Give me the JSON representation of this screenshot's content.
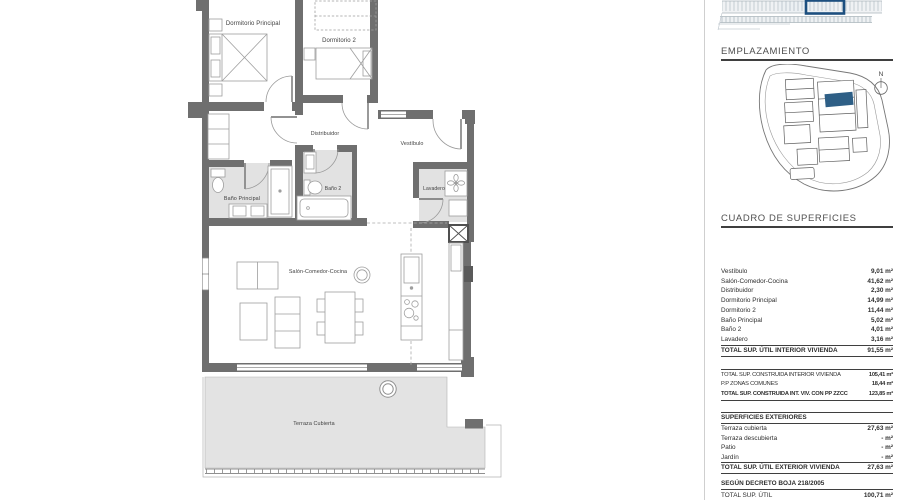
{
  "plan": {
    "labels": {
      "dorm_principal": "Dormitorio Principal",
      "dorm2": "Dormitorio 2",
      "distribuidor": "Distribuidor",
      "vestibulo": "Vestíbulo",
      "bano_principal": "Baño Principal",
      "bano2": "Baño 2",
      "lavadero": "Lavadero",
      "salon": "Salón-Comedor-Cocina",
      "terraza": "Terraza Cubierta"
    }
  },
  "sidebar": {
    "emplazamiento": {
      "title": "EMPLAZAMIENTO",
      "compass": "N"
    },
    "cuadro": {
      "title": "CUADRO DE SUPERFICIES"
    },
    "interior": {
      "rows": [
        {
          "label": "Vestíbulo",
          "value": "9,01 m²"
        },
        {
          "label": "Salón-Comedor-Cocina",
          "value": "41,62 m²"
        },
        {
          "label": "Distribuidor",
          "value": "2,30 m²"
        },
        {
          "label": "Dormitorio Principal",
          "value": "14,99 m²"
        },
        {
          "label": "Dormitorio 2",
          "value": "11,44 m²"
        },
        {
          "label": "Baño Principal",
          "value": "5,02 m²"
        },
        {
          "label": "Baño 2",
          "value": "4,01 m²"
        },
        {
          "label": "Lavadero",
          "value": "3,16 m²"
        }
      ],
      "total": {
        "label": "TOTAL SUP. ÚTIL INTERIOR VIVIENDA",
        "value": "91,55 m²"
      }
    },
    "construida": {
      "rows": [
        {
          "label": "TOTAL SUP. CONSTRUIDA INTERIOR VIVIENDA",
          "value": "105,41 m²"
        },
        {
          "label": "P.P ZONAS COMUNES",
          "value": "18,44 m²"
        },
        {
          "label": "TOTAL SUP. CONSTRUIDA INT. VIV. CON PP ZZCC",
          "value": "123,85 m²"
        }
      ]
    },
    "exteriores": {
      "header": "SUPERFICIES EXTERIORES",
      "rows": [
        {
          "label": "Terraza cubierta",
          "value": "27,63 m²"
        },
        {
          "label": "Terraza descubierta",
          "value": "- m²"
        },
        {
          "label": "Patio",
          "value": "- m²"
        },
        {
          "label": "Jardín",
          "value": "- m²"
        }
      ],
      "total": {
        "label": "TOTAL SUP. ÚTIL EXTERIOR VIVIENDA",
        "value": "27,63 m²"
      }
    },
    "decreto": {
      "header": "SEGÚN DECRETO BOJA 218/2005",
      "row": {
        "label": "TOTAL SUP. ÚTIL",
        "value": "100,71 m²"
      }
    }
  },
  "colors": {
    "wall": "#6f6f6f",
    "floor_gray": "#e2e2e2",
    "map_highlight": "#2e5f86",
    "elevation_outline": "#1d4f7f",
    "rule": "#3f3f3f"
  }
}
